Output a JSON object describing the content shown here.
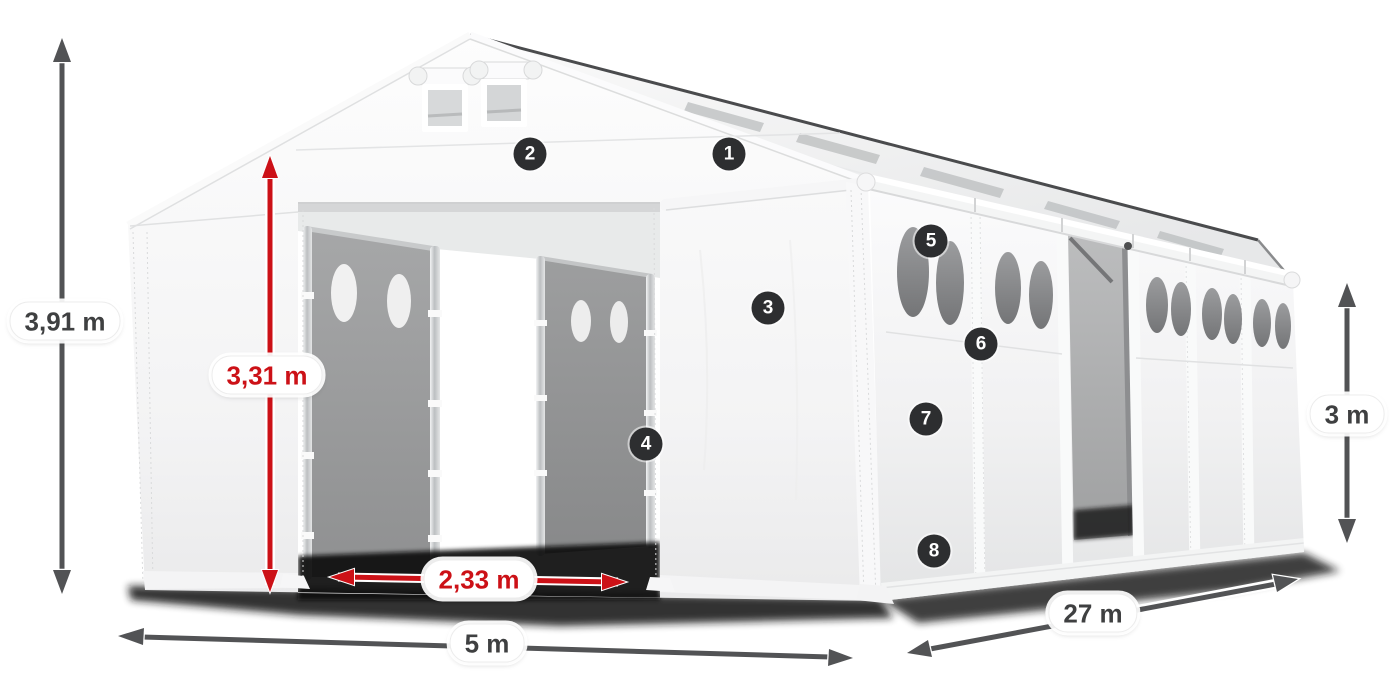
{
  "markers": [
    {
      "number": "1"
    },
    {
      "number": "2"
    },
    {
      "number": "3"
    },
    {
      "number": "4"
    },
    {
      "number": "5"
    },
    {
      "number": "6"
    },
    {
      "number": "7"
    },
    {
      "number": "8"
    }
  ],
  "dimensions": {
    "total_height": {
      "value": "3,91 m",
      "style": "gray"
    },
    "entrance_height": {
      "value": "3,31 m",
      "style": "red"
    },
    "entrance_width": {
      "value": "2,33 m",
      "style": "red"
    },
    "front_width": {
      "value": "5 m",
      "style": "gray"
    },
    "side_length": {
      "value": "27 m",
      "style": "gray"
    },
    "side_height": {
      "value": "3 m",
      "style": "gray"
    }
  },
  "colors": {
    "dimension_red": "#cc1117",
    "dimension_gray": "#525355",
    "label_text": "#3f4041",
    "marker_background": "#2d2e30",
    "marker_number": "#ffffff",
    "tent_white": "#f5f5f6",
    "interior_gray": "#9a9b9c"
  }
}
